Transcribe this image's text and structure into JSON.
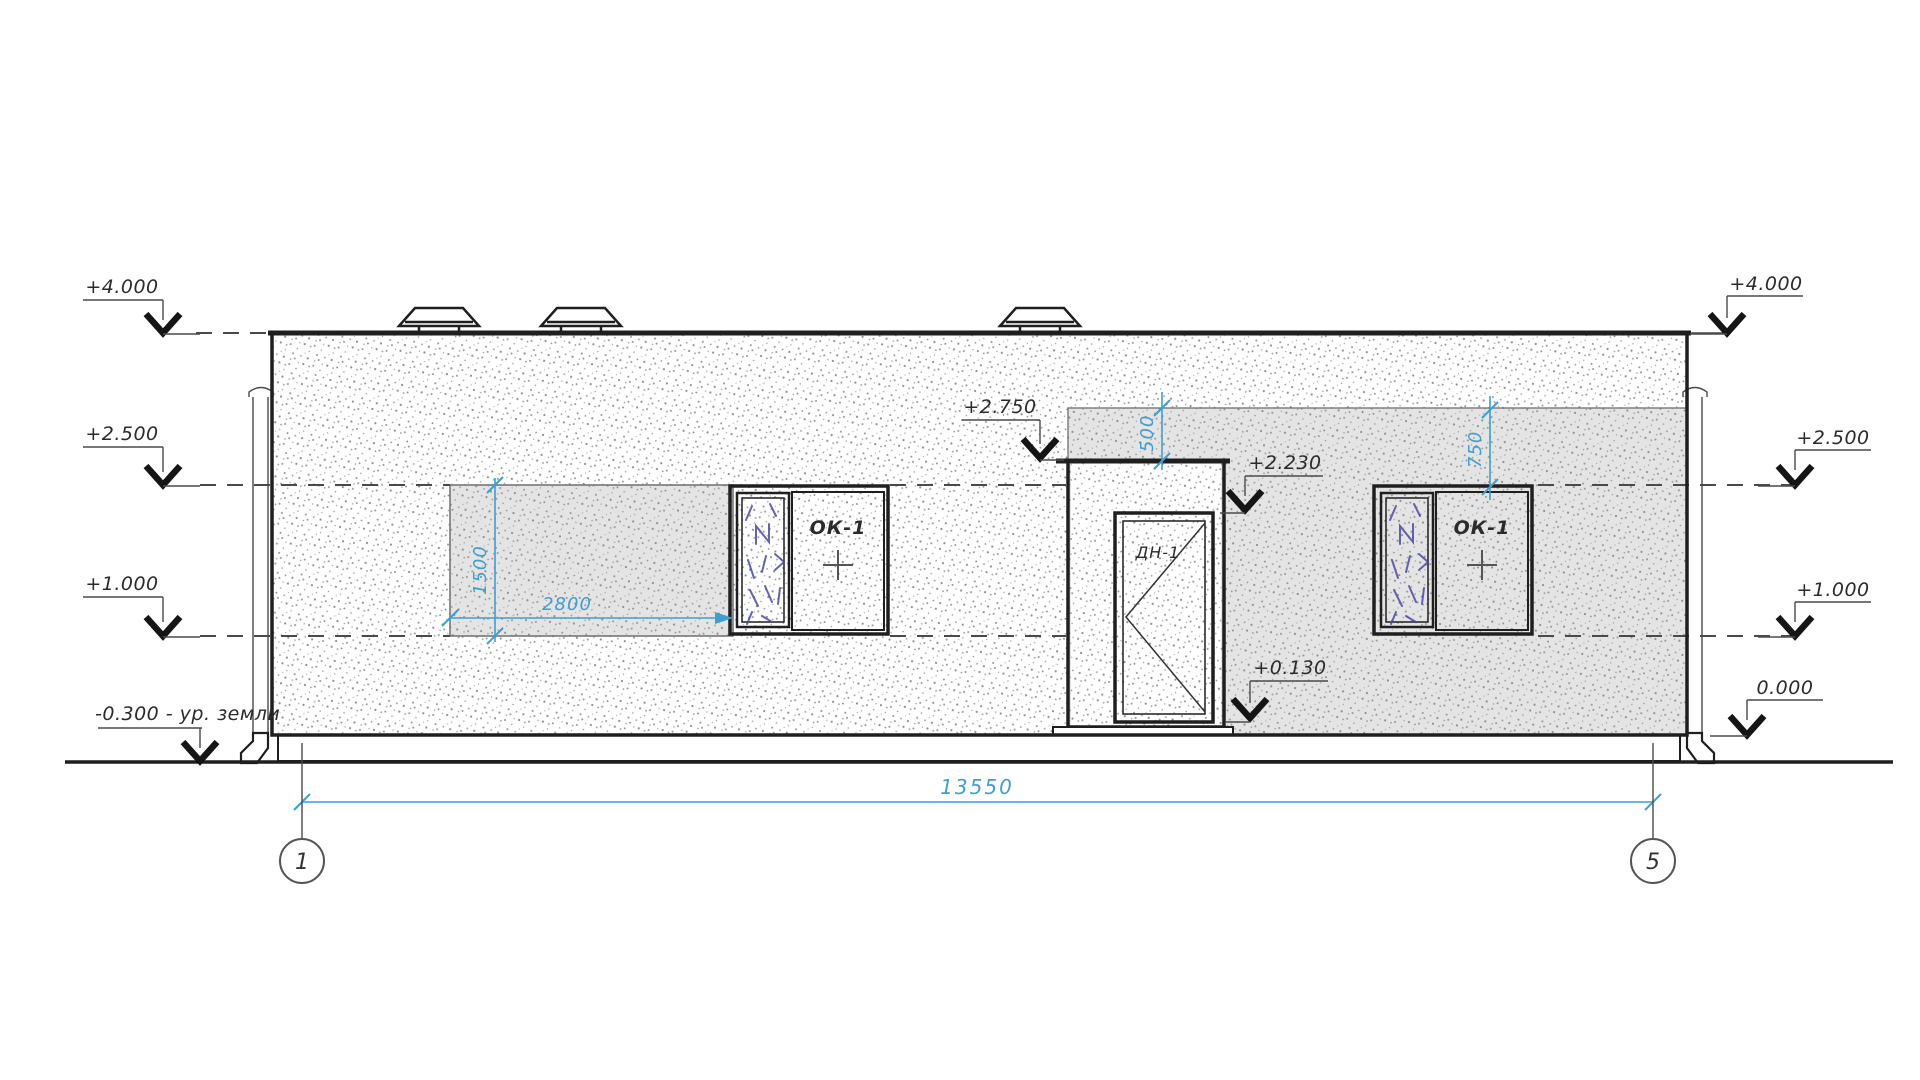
{
  "levels": {
    "left": [
      {
        "label": "+4.000"
      },
      {
        "label": "+2.500"
      },
      {
        "label": "+1.000"
      },
      {
        "label": "-0.300 - ур. земли"
      }
    ],
    "right": [
      {
        "label": "+4.000"
      },
      {
        "label": "+2.500"
      },
      {
        "label": "+1.000"
      },
      {
        "label": "0.000"
      }
    ],
    "middle": [
      {
        "label": "+2.750"
      },
      {
        "label": "+2.230"
      },
      {
        "label": "+0.130"
      }
    ]
  },
  "dimensions": {
    "overall_width": "13550",
    "opening_width": "2800",
    "opening_height": "1500",
    "canopy_drop": "500",
    "window_head_drop": "750"
  },
  "tags": {
    "window_left": "ОК-1",
    "window_right": "ОК-1",
    "door": "ДН-1"
  },
  "axes": {
    "start": "1",
    "end": "5"
  },
  "colors": {
    "dimension_blue": "#3f9fd0",
    "glazing_blue": "#4b49a8",
    "line_dark": "#1f1f1f",
    "shade_gray": "#e4e4e4"
  }
}
